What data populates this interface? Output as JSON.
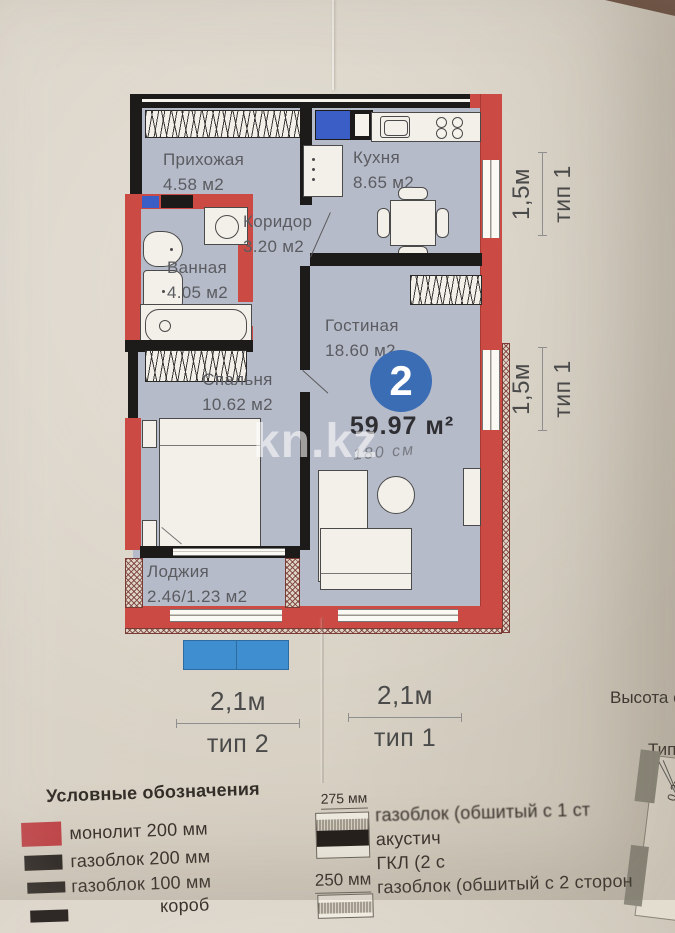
{
  "watermark": "kn.kz",
  "plan": {
    "rooms": [
      {
        "name": "Прихожая",
        "area": "4.58 м2"
      },
      {
        "name": "Кухня",
        "area": "8.65 м2"
      },
      {
        "name": "Коридор",
        "area": "3.20 м2"
      },
      {
        "name": "Ванная",
        "area": "4.05 м2"
      },
      {
        "name": "Гостиная",
        "area": "18.60 м2"
      },
      {
        "name": "Спальня",
        "area": "10.62 м2"
      },
      {
        "name": "Лоджия",
        "area": "2.46/1.23 м2"
      }
    ],
    "badge": {
      "number": "2",
      "total_area": "59.97 м²",
      "handwritten_note": "180 см"
    }
  },
  "dimensions": {
    "right": [
      {
        "length": "1,5м",
        "type": "тип 1"
      },
      {
        "length": "1,5м",
        "type": "тип 1"
      }
    ],
    "bottom": [
      {
        "length": "2,1м",
        "type": "тип 2"
      },
      {
        "length": "2,1м",
        "type": "тип 1"
      }
    ]
  },
  "side_panel": {
    "height_note": "Высота о",
    "type_note": "Тип",
    "dim_note": "0,2м"
  },
  "legend": {
    "title": "Условные обозначения",
    "materials": [
      {
        "label": "монолит 200 мм",
        "color": "#c24549"
      },
      {
        "label": "газоблок 200 мм",
        "color": "#2e2926"
      },
      {
        "label": "газоблок 100 мм",
        "color": "#2e2926"
      },
      {
        "label": "короб",
        "color": "#2e2926"
      }
    ],
    "wall_types": [
      {
        "size": "275 мм",
        "lines": [
          "газоблок (обшитый с 1 ст",
          "акустич",
          "ГКЛ (2 с"
        ]
      },
      {
        "size": "250 мм",
        "lines": [
          "газоблок (обшитый с 2 сторон"
        ]
      }
    ]
  },
  "colors": {
    "wall_red": "#cb4a43",
    "floor": "#b6bbc9",
    "badge_blue": "#3a6db3",
    "marker_blue": "#3f8ed0"
  }
}
